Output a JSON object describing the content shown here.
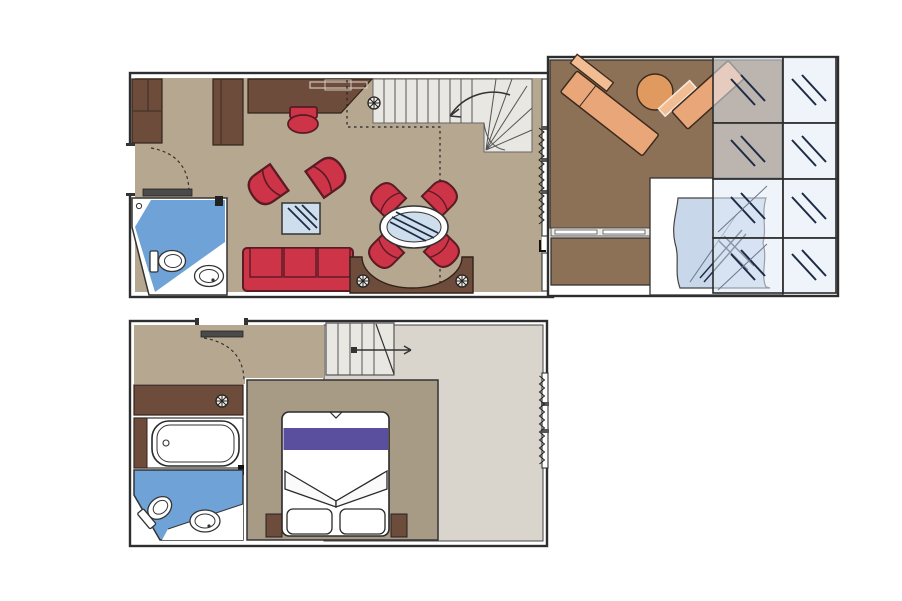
{
  "meta": {
    "type": "duplex-suite-floorplan",
    "decks": 2,
    "text_labels": []
  },
  "palette": {
    "floor": "#b6a890",
    "floor2": "#a89b86",
    "brown": "#6d4c3c",
    "balcony": "#8d7157",
    "stair": "#e9e7e2",
    "gray": "#d9d5cd",
    "red": "#ce3448",
    "redline": "#5a1b24",
    "blue": "#6fa3d7",
    "glass": "#cfdeed",
    "panel": "rgba(226,235,247,0.55)",
    "navy": "#1d2b45",
    "tub": "#c9d7ea",
    "purple": "#5a4f9e",
    "lounger": "#e9a678",
    "loungerLight": "#f2bd93",
    "wall": "#2e2e2e",
    "table": "#e09a60",
    "door": "#4a4a4a"
  },
  "symbols": [
    "sprinkler-icon",
    "curtain-zigzag-icon",
    "glass-pane-mark-icon",
    "door-swing-arc-icon",
    "stair-direction-arrow-icon"
  ],
  "upper_deck": {
    "rooms": [
      "entrance",
      "living-dining-room",
      "guest-bathroom",
      "staircase",
      "balcony",
      "whirlpool-area"
    ],
    "furniture": [
      "wardrobe",
      "desk",
      "stool",
      "armchair",
      "armchair",
      "coffee-table",
      "three-seat-sofa",
      "oval-dining-table",
      "dining-chair",
      "dining-chair",
      "dining-chair",
      "dining-chair",
      "curved-counter",
      "sun-lounger",
      "sun-lounger",
      "round-table",
      "whirlpool-tub",
      "toilet",
      "washbasin"
    ],
    "glass_panels": {
      "columns": 2,
      "rows": 4
    }
  },
  "lower_deck": {
    "rooms": [
      "corridor",
      "bedroom",
      "bathroom",
      "staircase",
      "open-void-area"
    ],
    "furniture": [
      "wardrobe",
      "bathtub",
      "toilet",
      "washbasin",
      "double-bed",
      "pillow",
      "pillow",
      "nightstand",
      "nightstand"
    ]
  }
}
